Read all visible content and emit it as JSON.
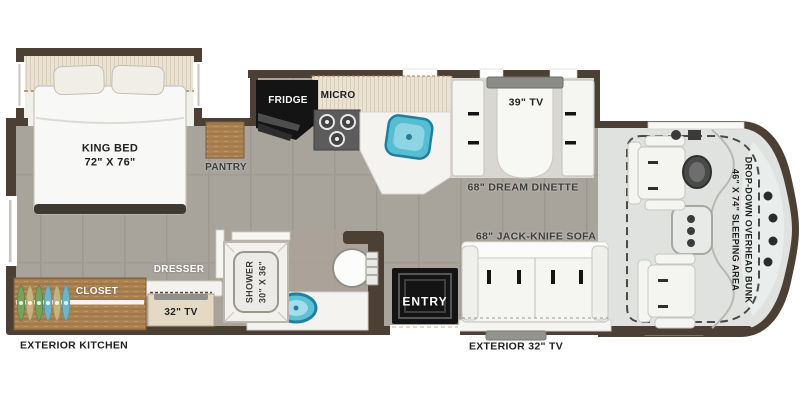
{
  "labels": {
    "king_bed_line1": "KING BED",
    "king_bed_line2": "72\" X 76\"",
    "pantry": "PANTRY",
    "fridge": "FRIDGE",
    "micro": "MICRO",
    "tv39": "39\" TV",
    "dinette": "68\" DREAM DINETTE",
    "bunk_line1": "DROP-DOWN OVERHEAD BUNK",
    "bunk_line2": "46\" X 74\" SLEEPING AREA",
    "sofa": "68\" JACK-KNIFE SOFA",
    "entry": "ENTRY",
    "exterior_tv": "EXTERIOR 32\" TV",
    "exterior_kitchen": "EXTERIOR KITCHEN",
    "closet": "CLOSET",
    "dresser": "DRESSER",
    "tv32": "32\" TV",
    "shower_line1": "SHOWER",
    "shower_line2": "30\" X 36\""
  },
  "colors": {
    "wall": "#4c4035",
    "floor": "#a8a49c",
    "wood": "#ab8156",
    "counter_white": "#f5f4f1",
    "appliance_black": "#141414",
    "sink_blue": "#57bdd3",
    "cab_floor": "#dfe2df",
    "cabinet_beige": "#e9e1d1",
    "tv_gray": "#8b8b88",
    "hanger_green": "#76a35c",
    "hanger_tan": "#c6b27e",
    "hanger_blue": "#6fb5c6"
  }
}
